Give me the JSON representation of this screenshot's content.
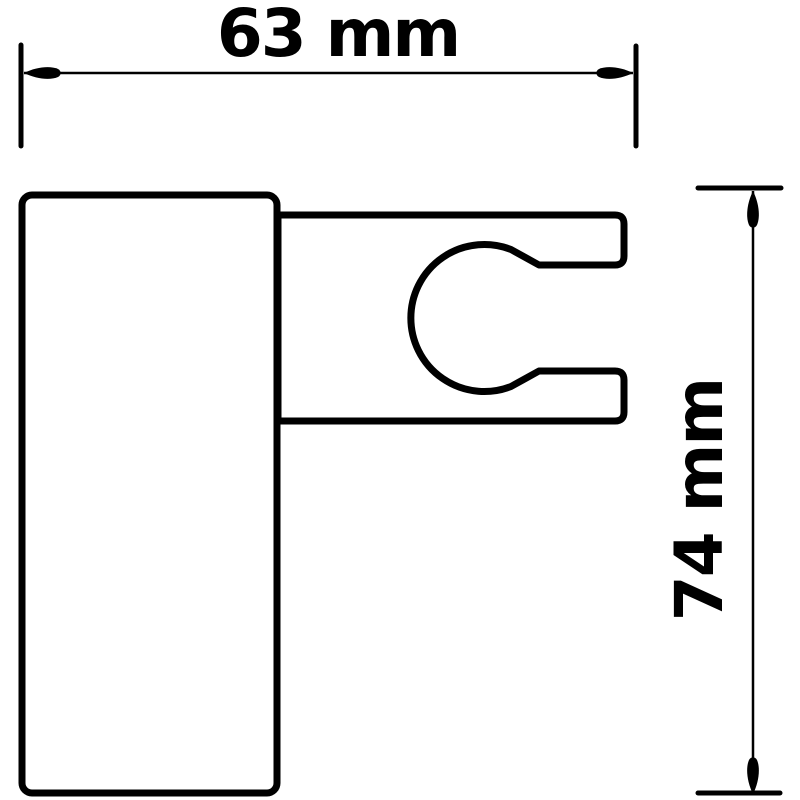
{
  "drawing": {
    "type": "technical-dimension-drawing",
    "subject": "wall-mount handheld shower holder bracket, side view",
    "ink_color": "#000000",
    "paper_color": "#ffffff",
    "dimensions": {
      "width": {
        "label": "63 mm",
        "value": 63,
        "unit": "mm",
        "orientation": "horizontal"
      },
      "height": {
        "label": "74 mm",
        "value": 74,
        "unit": "mm",
        "orientation": "vertical"
      }
    }
  }
}
